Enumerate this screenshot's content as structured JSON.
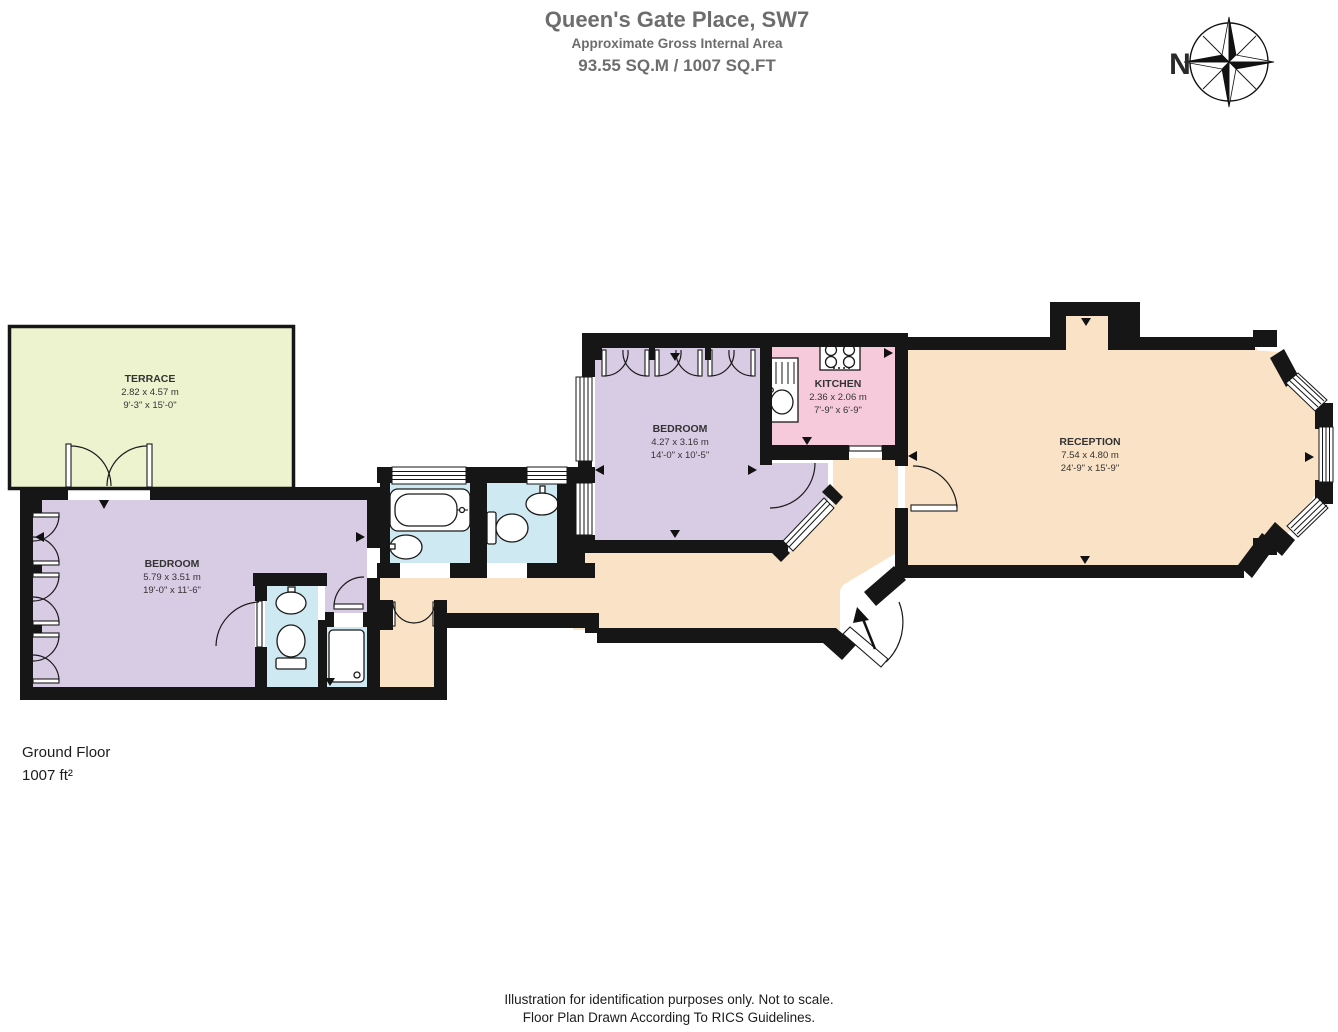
{
  "header": {
    "title": "Queen's Gate Place, SW7",
    "subtitle": "Approximate Gross Internal Area",
    "area_line": "93.55 SQ.M / 1007 SQ.FT"
  },
  "compass": {
    "north_label": "N"
  },
  "floor_plan": {
    "rooms": [
      {
        "name": "TERRACE",
        "size_metric": "2.82 x  4.57 m",
        "size_imperial": "9'-3\" x  15'-0\""
      },
      {
        "name": "BEDROOM",
        "size_metric": "5.79 x 3.51 m",
        "size_imperial": "19'-0\" x 11'-6\""
      },
      {
        "name": "BEDROOM",
        "size_metric": "4.27 x 3.16 m",
        "size_imperial": "14'-0\" x 10'-5\""
      },
      {
        "name": "KITCHEN",
        "size_metric": "2.36 x 2.06 m",
        "size_imperial": "7'-9\" x 6'-9\""
      },
      {
        "name": "RECEPTION",
        "size_metric": "7.54 x 4.80 m",
        "size_imperial": "24'-9\" x 15'-9\""
      }
    ]
  },
  "floor_info": {
    "name": "Ground Floor",
    "area": "1007 ft²"
  },
  "footer": {
    "line1": "Illustration for identification purposes only. Not to scale.",
    "line2": "Floor Plan Drawn According To RICS Guidelines."
  },
  "colors": {
    "terrace": "#edf2cf",
    "bedroom": "#d8cbe4",
    "bathroom": "#cfe9f2",
    "kitchen": "#f6cadb",
    "reception": "#f9e2c6",
    "wall": "#161616"
  }
}
